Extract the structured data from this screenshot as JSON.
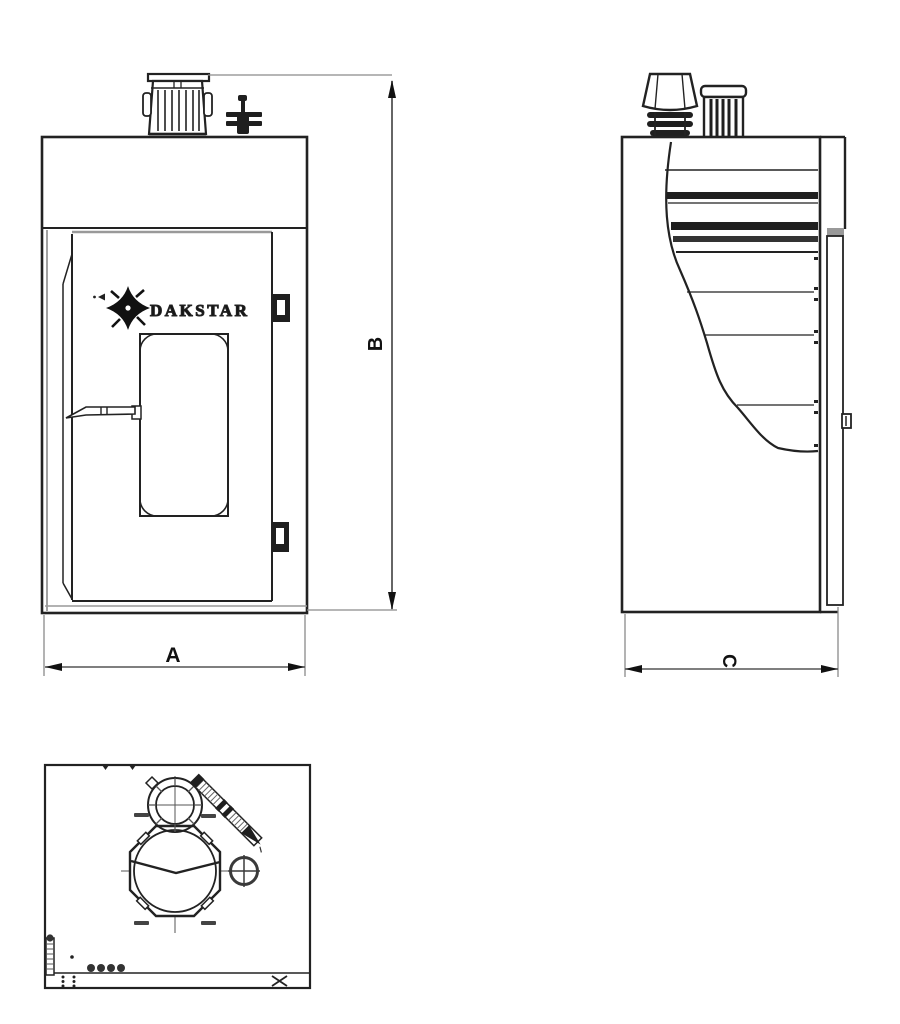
{
  "drawing": {
    "brand": "DAKSTAR",
    "dim_a": "A",
    "dim_b": "B",
    "dim_c": "C",
    "colors": {
      "line": "#222222",
      "band": "#1f1f1f",
      "dim_line": "#555555",
      "extension_line": "#8a8a8a",
      "label": "#111111",
      "shadow": "#999999",
      "background": "#ffffff"
    }
  }
}
